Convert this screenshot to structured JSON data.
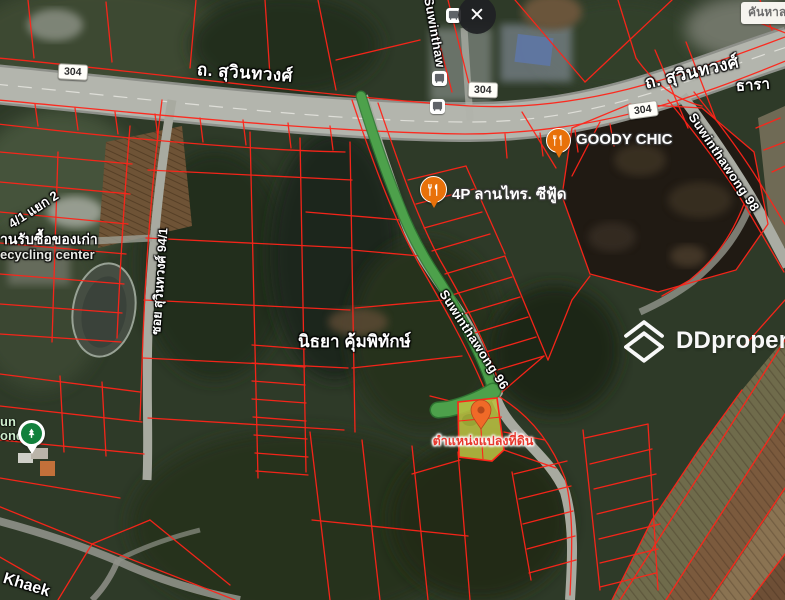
{
  "ui": {
    "close_glyph": "✕"
  },
  "watermark": {
    "brand": "DDproperty"
  },
  "roads": {
    "main_left": "ถ. สุวินทวงศ์",
    "main_right": "ถ. สุวินทวงศ์",
    "main_partial_vertical": "Suwinthaw",
    "shield": "304",
    "soi_94_1": "ซอย สุวินทวงศ์ 94/1",
    "yaek": "4/1 แยก 2",
    "soi_96": "Suwinthawong 96",
    "soi_98": "Suwinthawong 98"
  },
  "places": {
    "nithaya": "นิธยา คุ้มพิทักษ์",
    "thara": "ธารา",
    "khaek": "Khaek",
    "junk_shop_th": "านรับซื้อของเก่า",
    "junk_shop_en": "ecycling center",
    "khan_han": "คันหาล",
    "park_fragment_1": "un",
    "park_fragment_2": "ond"
  },
  "poi": {
    "goody_chic": "GOODY CHIC",
    "lan_sai": "4P ลานไทร. ซีฟู้ด"
  },
  "plot": {
    "label": "ตำแหน่งแปลงที่ดิน"
  },
  "colors": {
    "cadastral_line": "#ff2419",
    "route_highlight": "#4da14b",
    "plot_fill": "#b9bf41",
    "plot_label_text": "#e8392e",
    "poi_marker_orange": "#e8710a",
    "park_marker_green": "#12803c",
    "road_shield_bg": "#fffef9",
    "watermark_text": "#ffffff"
  }
}
